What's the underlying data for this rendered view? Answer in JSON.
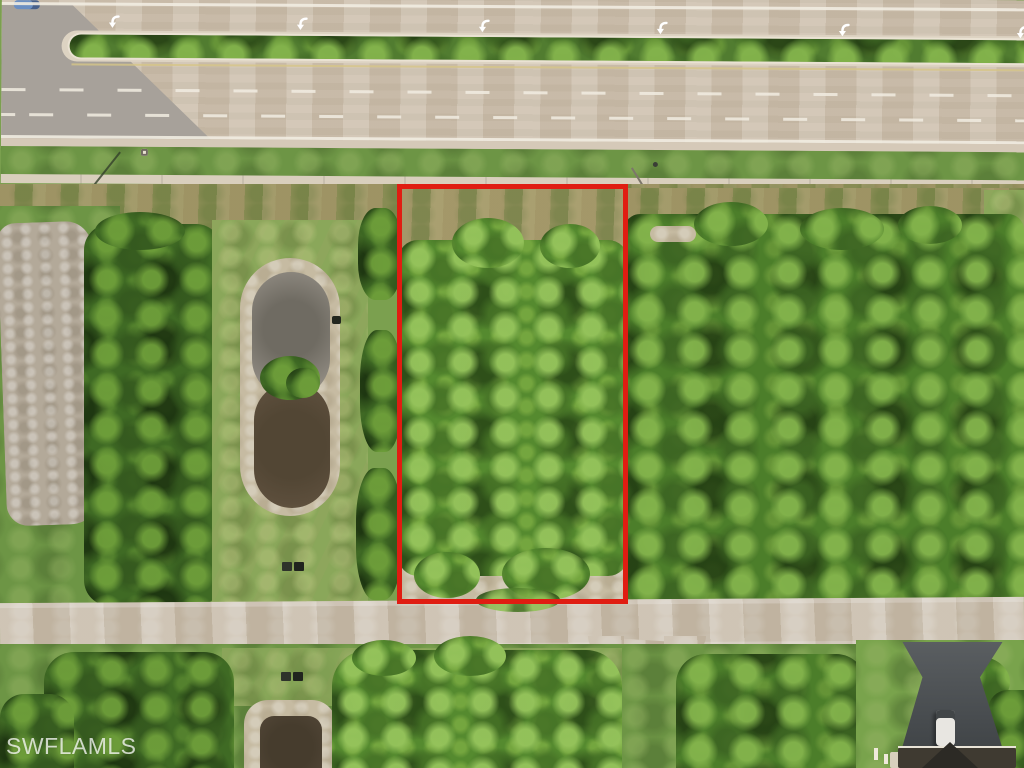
{
  "watermark": {
    "text": "SWFLAMLS"
  },
  "boundary": {
    "color": "#e01d12"
  },
  "icons": {
    "lane_arrow": "u-turn-arrow-icon"
  },
  "palette": {
    "highway_pavement": "#cfc2b0",
    "cross_street_pavement": "#a7a19a",
    "median_grass": "#517c30",
    "lane_marking": "#f1ece1",
    "roadside_grass": "#6d9545",
    "sidewalk_concrete": "#d9cfbd",
    "scrub_ground": "#98955f",
    "tree_canopy_dark": "#3f6a24",
    "tree_canopy_bright": "#558a2f",
    "cleared_dirt": "#b3a999",
    "pond_mud": "#8b867d",
    "pond_water": "#5c4e3c",
    "dirt_road": "#c7bba9",
    "driveway_asphalt": "#45494d",
    "car_black": "#16191d",
    "truck_white": "#e8e6e1"
  }
}
